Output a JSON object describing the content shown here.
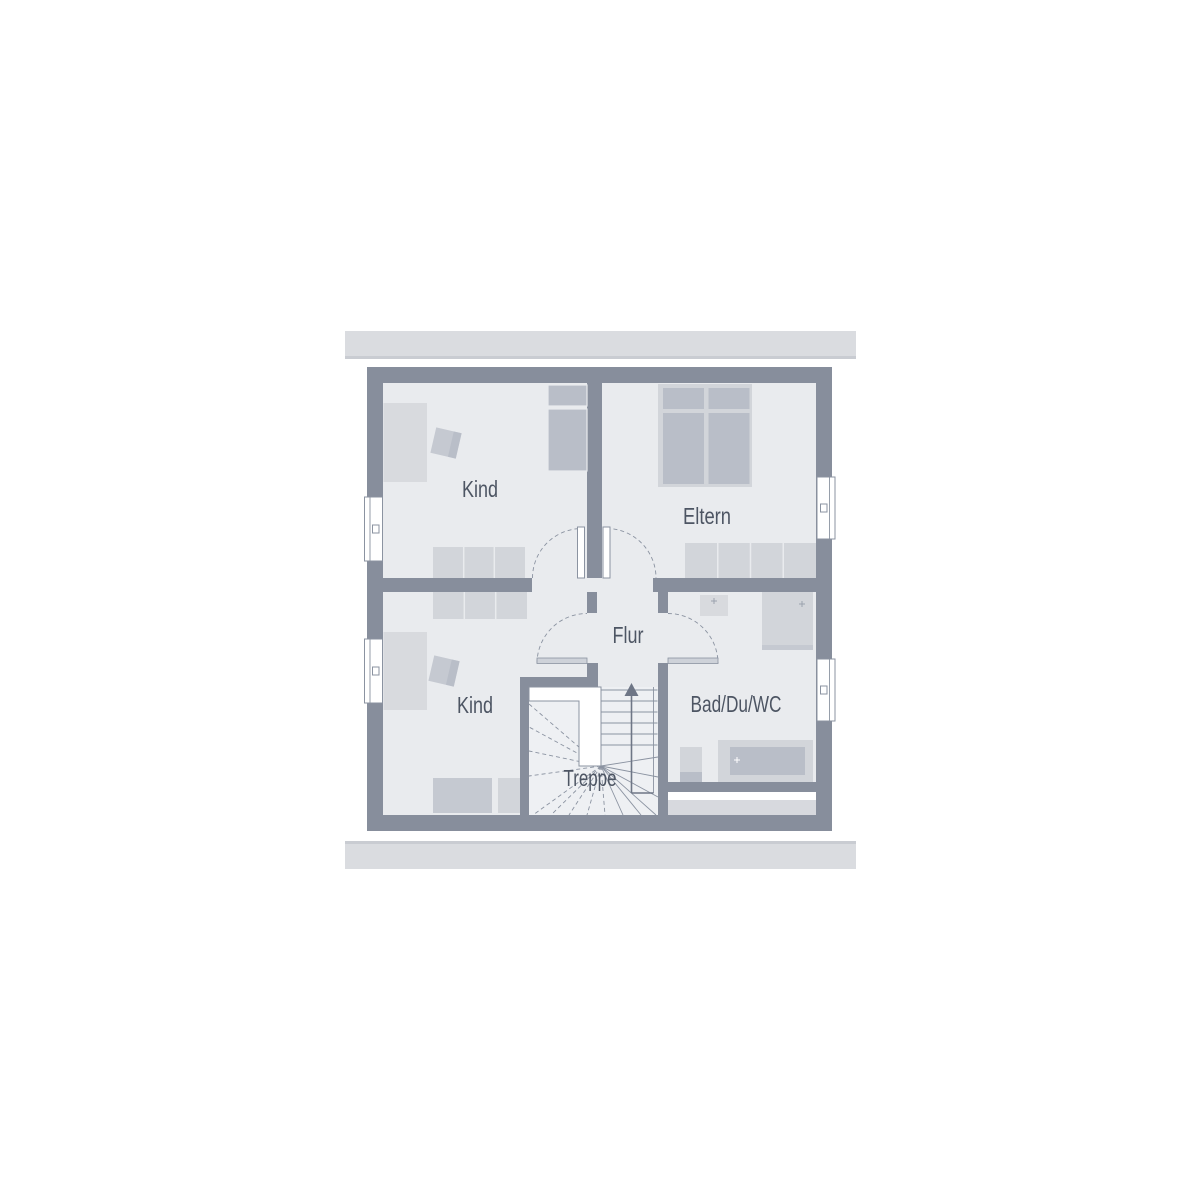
{
  "plan": {
    "type": "floor-plan",
    "rooms": {
      "kind_top": {
        "label": "Kind"
      },
      "eltern": {
        "label": "Eltern"
      },
      "kind_bottom": {
        "label": "Kind"
      },
      "flur": {
        "label": "Flur"
      },
      "treppe": {
        "label": "Treppe"
      },
      "bad": {
        "label": "Bad/Du/WC"
      }
    }
  },
  "colors": {
    "canvas": "#ffffff",
    "wall": "#878e9c",
    "floor": "#e9ebee",
    "stair_floor": "#eef0f3",
    "roof_bar": "#dadce0",
    "roof_bar_edge": "#c9ccd2",
    "furn_light": "#d2d5da",
    "furn_med": "#c5c9d1",
    "furn_dark": "#b9bec8",
    "furn_pale": "#d8dade",
    "door_leaf": "#ced2d9",
    "strip": "#d7d9de",
    "line": "#8b93a1",
    "arrow": "#6e7686",
    "mark": "#9ba2ae",
    "window": "#ffffff",
    "text": "#4d5563"
  }
}
